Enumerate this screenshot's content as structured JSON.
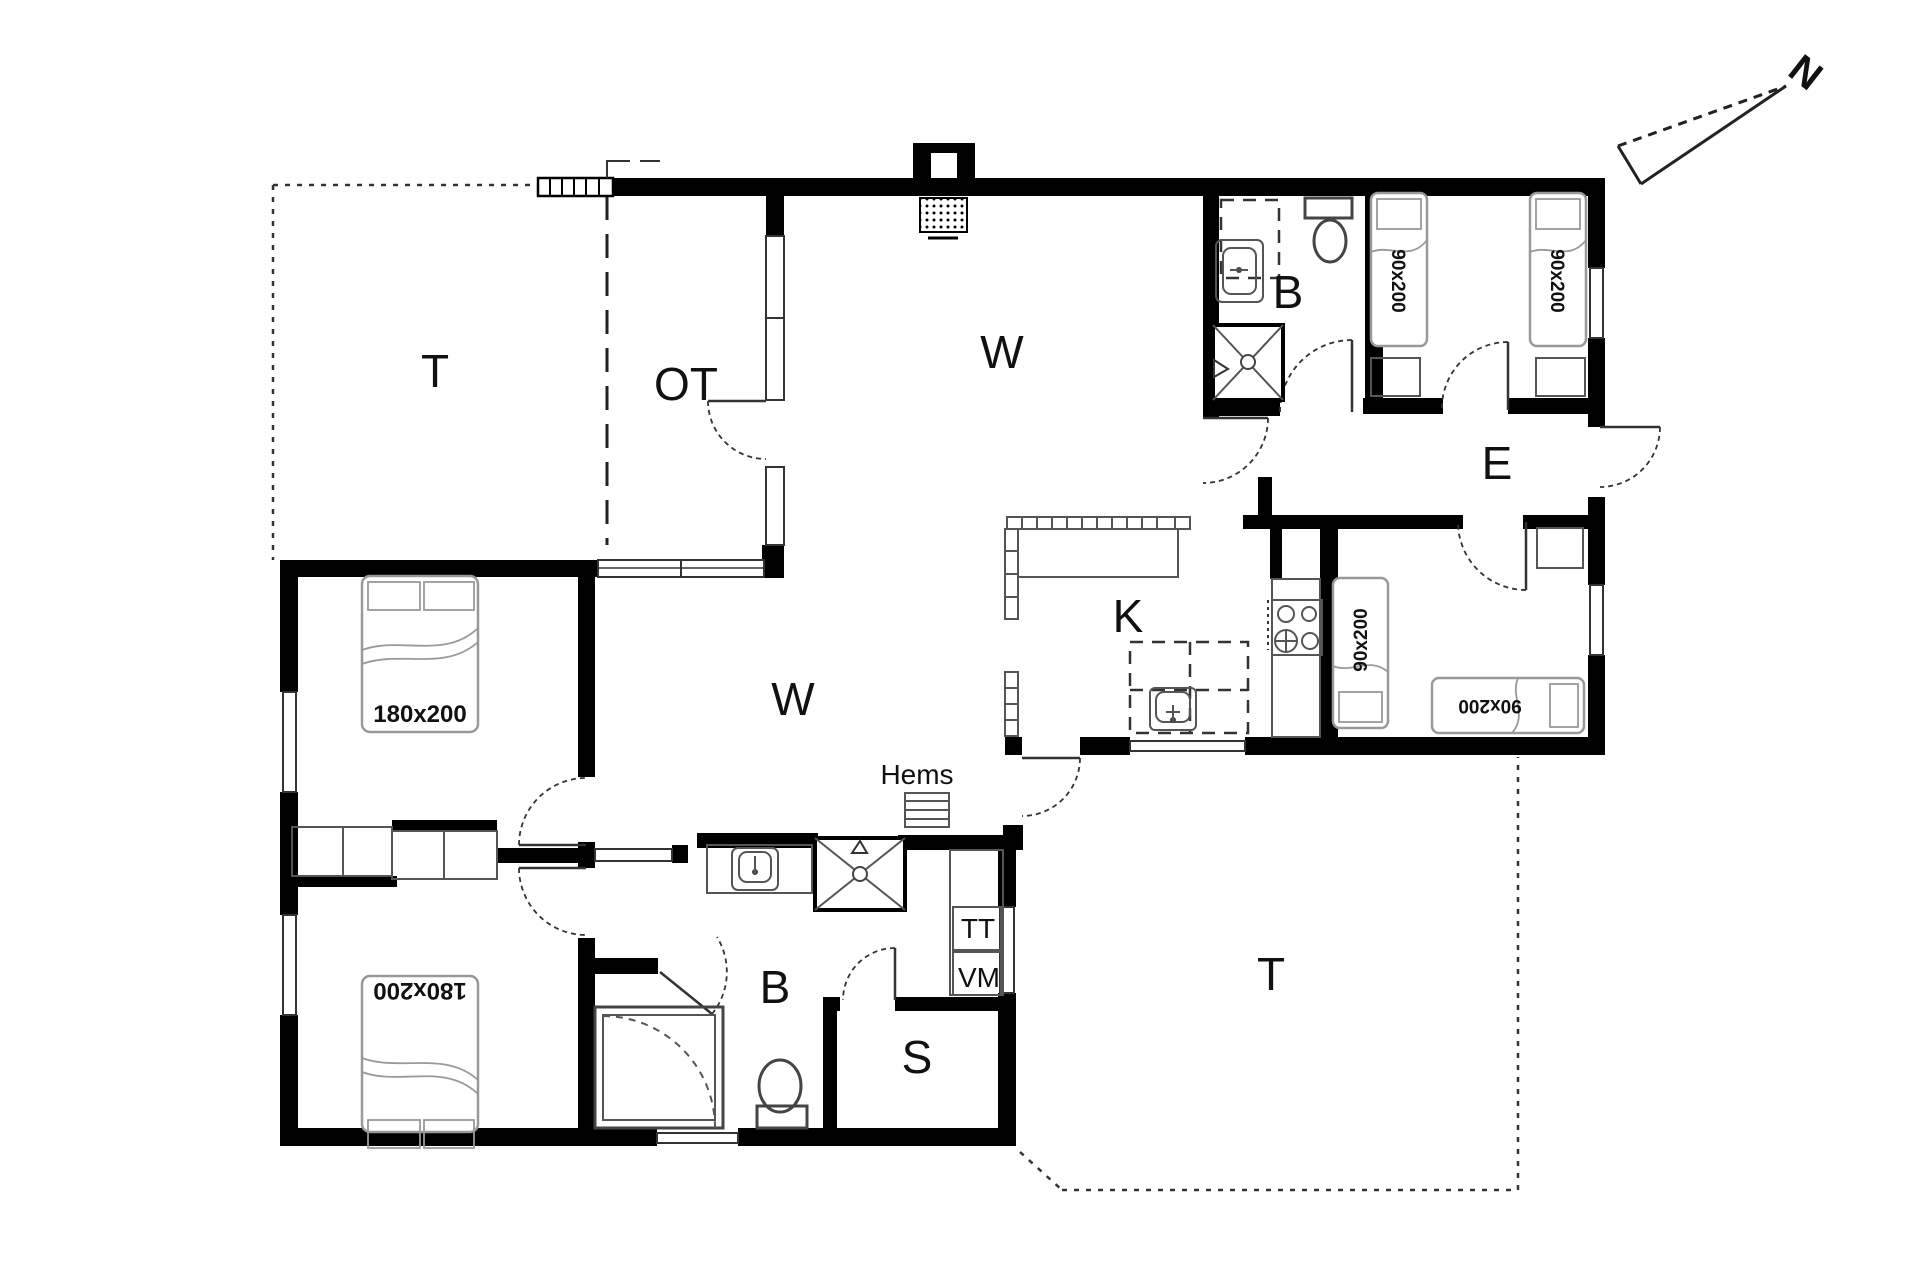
{
  "plan": {
    "background": "#ffffff",
    "wall_color": "#000000",
    "fixture_line_color": "#555555",
    "bed_line_color": "#999999",
    "compass": {
      "label": "N"
    },
    "rooms": {
      "terrace_top": {
        "label": "T"
      },
      "covered_terrace": {
        "label": "OT"
      },
      "living": {
        "label": "W"
      },
      "bath_top": {
        "label": "B"
      },
      "entry": {
        "label": "E"
      },
      "kitchen": {
        "label": "K"
      },
      "living_mid": {
        "label": "W"
      },
      "loft": {
        "label": "Hems"
      },
      "bath_bottom": {
        "label": "B"
      },
      "storage": {
        "label": "S"
      },
      "terrace_bottom": {
        "label": "T"
      }
    },
    "appliances": {
      "dryer": {
        "label": "TT"
      },
      "washer": {
        "label": "VM"
      }
    },
    "beds": {
      "double_top": {
        "label": "180x200"
      },
      "double_bottom": {
        "label": "180x200"
      },
      "single_top_1": {
        "label": "90x200"
      },
      "single_top_2": {
        "label": "90x200"
      },
      "single_mid_1": {
        "label": "90x200"
      },
      "single_mid_2": {
        "label": "90x200"
      }
    }
  }
}
